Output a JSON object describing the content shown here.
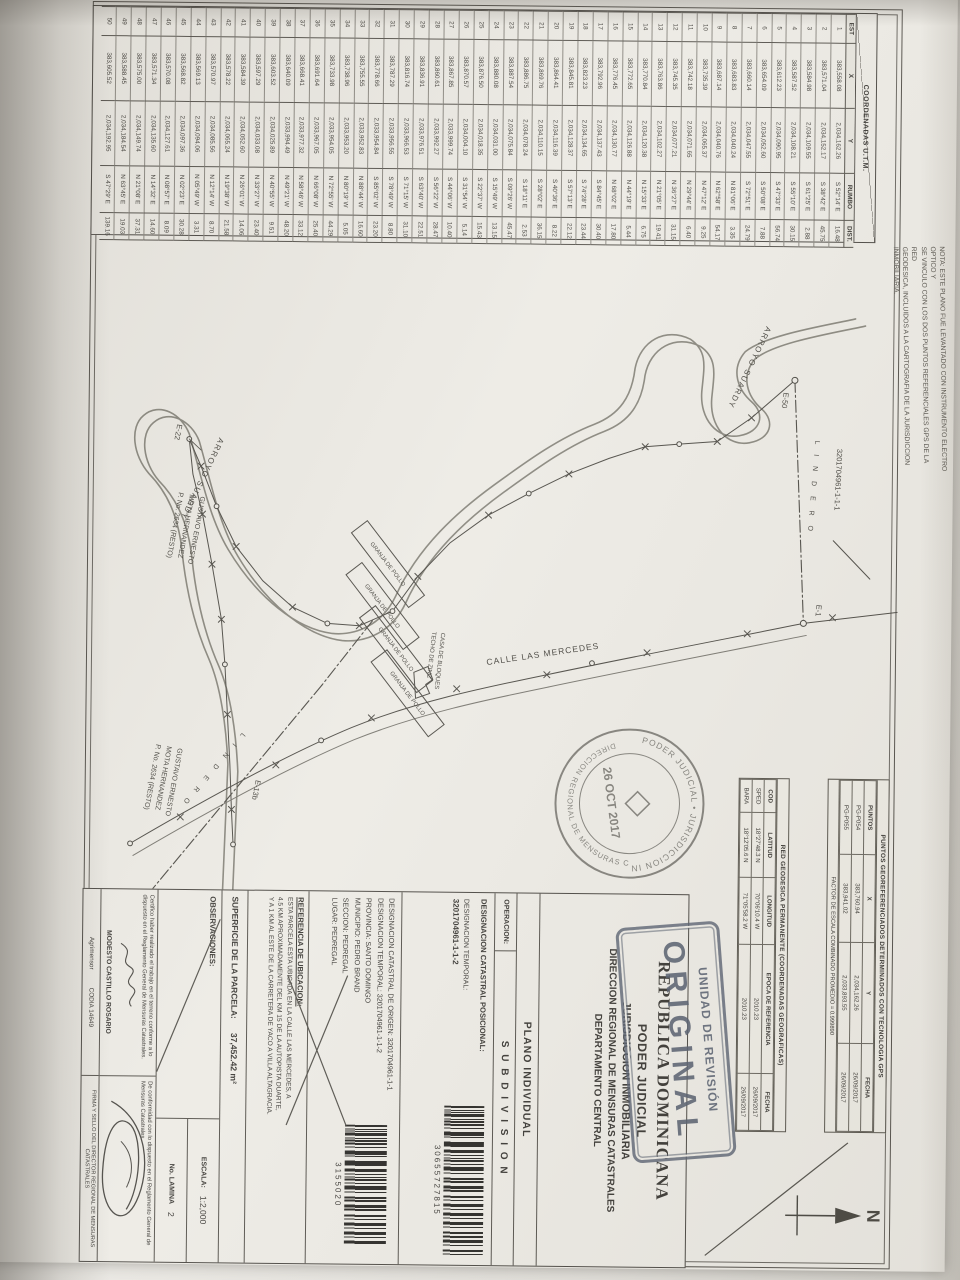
{
  "colors": {
    "ink": "#3c3a36",
    "stamp_ink": "#586070",
    "paper": "#edebe5",
    "stream": "#8a887f"
  },
  "note_margin": {
    "lines": [
      "NOTA: ESTE PLANO FUE LEVANTADO CON INSTRUMENTO ELECTRO OPTICO Y",
      "SE VINCULO CON LOS DOS PUNTOS REFERENCIALES GPS DE LA RED",
      "GEODESICA, INCLUIDOS A LA CARTOGRAFIA DE LA JURISDICCION",
      "INMOBILIARIA."
    ]
  },
  "compass": {
    "label": "N"
  },
  "coord_table": {
    "title": "COORDENADAS U.T.M.",
    "columns": [
      "EST",
      "X",
      "Y",
      "RUMBO",
      "DIST."
    ],
    "rows": [
      [
        "1",
        "383,558.08",
        "2,034,162.26",
        "S 52°14' E",
        "16.48"
      ],
      [
        "2",
        "383,571.04",
        "2,034,152.17",
        "S 38°42' E",
        "45.75"
      ],
      [
        "3",
        "383,584.98",
        "2,034,109.55",
        "S 61°25' E",
        "2.88"
      ],
      [
        "4",
        "383,587.52",
        "2,034,108.21",
        "S 55°10' E",
        "30.15"
      ],
      [
        "5",
        "383,612.23",
        "2,034,090.95",
        "S 47°33' E",
        "56.74"
      ],
      [
        "6",
        "383,654.09",
        "2,034,052.60",
        "S 50°08' E",
        "7.88"
      ],
      [
        "7",
        "383,660.14",
        "2,034,047.55",
        "S 72°51' E",
        "24.79"
      ],
      [
        "8",
        "383,683.83",
        "2,034,040.24",
        "N 81°06' E",
        "3.35"
      ],
      [
        "9",
        "383,687.14",
        "2,034,040.76",
        "N 62°58' E",
        "54.17"
      ],
      [
        "10",
        "383,735.39",
        "2,034,065.37",
        "N 47°12' E",
        "9.25"
      ],
      [
        "11",
        "383,742.18",
        "2,034,071.65",
        "N 29°44' E",
        "6.40"
      ],
      [
        "12",
        "383,745.35",
        "2,034,077.21",
        "N 36°27' E",
        "31.15"
      ],
      [
        "13",
        "383,763.86",
        "2,034,102.27",
        "N 21°05' E",
        "19.41"
      ],
      [
        "14",
        "383,770.84",
        "2,034,120.38",
        "N 15°33' E",
        "6.75"
      ],
      [
        "15",
        "383,772.65",
        "2,034,126.88",
        "N 44°19' E",
        "5.44"
      ],
      [
        "16",
        "383,776.45",
        "2,034,130.77",
        "N 68°02' E",
        "17.80"
      ],
      [
        "17",
        "383,792.96",
        "2,034,137.43",
        "S 84°45' E",
        "30.40"
      ],
      [
        "18",
        "383,823.23",
        "2,034,134.65",
        "S 74°28' E",
        "23.44"
      ],
      [
        "19",
        "383,845.81",
        "2,034,128.37",
        "S 57°13' E",
        "22.12"
      ],
      [
        "20",
        "383,864.41",
        "2,034,116.39",
        "S 40°36' E",
        "8.22"
      ],
      [
        "21",
        "383,869.76",
        "2,034,110.15",
        "S 28°02' E",
        "36.15"
      ],
      [
        "22",
        "383,886.75",
        "2,034,078.24",
        "S 18°11' E",
        "2.53"
      ],
      [
        "23",
        "383,887.54",
        "2,034,075.84",
        "S 09°26' W",
        "45.47"
      ],
      [
        "24",
        "383,880.08",
        "2,034,031.00",
        "S 15°49' W",
        "13.15"
      ],
      [
        "25",
        "383,876.50",
        "2,034,018.35",
        "S 22°37' W",
        "15.43"
      ],
      [
        "26",
        "383,870.57",
        "2,034,004.10",
        "S 31°54' W",
        "5.14"
      ],
      [
        "27",
        "383,867.85",
        "2,033,999.74",
        "S 44°06' W",
        "10.40"
      ],
      [
        "28",
        "383,860.61",
        "2,033,992.27",
        "S 56°22' W",
        "28.47"
      ],
      [
        "29",
        "383,836.91",
        "2,033,976.51",
        "S 63°40' W",
        "22.51"
      ],
      [
        "30",
        "383,816.74",
        "2,033,966.53",
        "S 71°15' W",
        "31.10"
      ],
      [
        "31",
        "383,787.29",
        "2,033,956.55",
        "S 78°49' W",
        "8.80"
      ],
      [
        "32",
        "383,778.66",
        "2,033,954.84",
        "S 85°02' W",
        "23.20"
      ],
      [
        "33",
        "383,755.55",
        "2,033,952.83",
        "N 88°44' W",
        "16.60"
      ],
      [
        "34",
        "383,738.96",
        "2,033,953.20",
        "N 80°19' W",
        "5.05"
      ],
      [
        "35",
        "383,733.98",
        "2,033,954.05",
        "N 72°55' W",
        "44.29"
      ],
      [
        "36",
        "383,691.64",
        "2,033,967.05",
        "N 66°08' W",
        "25.40"
      ],
      [
        "37",
        "383,668.41",
        "2,033,977.32",
        "N 58°46' W",
        "33.12"
      ],
      [
        "38",
        "383,640.09",
        "2,033,994.49",
        "N 49°21' W",
        "48.20"
      ],
      [
        "39",
        "383,603.52",
        "2,034,025.89",
        "N 40°55' W",
        "9.51"
      ],
      [
        "40",
        "383,597.29",
        "2,034,033.08",
        "N 33°27' W",
        "23.40"
      ],
      [
        "41",
        "383,584.39",
        "2,034,052.60",
        "N 26°01' W",
        "14.06"
      ],
      [
        "42",
        "383,578.22",
        "2,034,065.24",
        "N 19°38' W",
        "21.58"
      ],
      [
        "43",
        "383,570.97",
        "2,034,085.56",
        "N 12°14' W",
        "8.70"
      ],
      [
        "44",
        "383,569.13",
        "2,034,094.06",
        "N 05°49' W",
        "3.31"
      ],
      [
        "45",
        "383,568.82",
        "2,034,097.36",
        "N 02°23' E",
        "30.28"
      ],
      [
        "46",
        "383,570.08",
        "2,034,127.61",
        "N 08°57' E",
        "8.09"
      ],
      [
        "47",
        "383,571.34",
        "2,034,135.60",
        "N 14°32' E",
        "14.60"
      ],
      [
        "48",
        "383,575.00",
        "2,034,149.74",
        "N 21°08' E",
        "37.31"
      ],
      [
        "49",
        "383,588.45",
        "2,034,184.54",
        "N 63°45' E",
        "19.03"
      ],
      [
        "50",
        "383,605.52",
        "2,034,192.95",
        "S 47°29' E",
        "139.16"
      ]
    ]
  },
  "geo_table_gps": {
    "title": "PUNTOS GEOREFERENCIADOS DETERMINADOS CON TECNOLOGIA GPS",
    "columns": [
      "PUNTOS",
      "X",
      "Y",
      "FECHA"
    ],
    "rows": [
      [
        "PG-P054",
        "383,760.94",
        "2,034,162.26",
        "26/09/2017"
      ],
      [
        "PG-P055",
        "383,941.02",
        "2,033,893.55",
        "26/09/2017"
      ]
    ],
    "factor_note": "FACTOR DE ESCALA COMBINADO PROMEDIO = 0.999890"
  },
  "geo_table_red": {
    "title": "RED GEODESICA PERMANENTE (COORDENADAS GEOGRAFICAS)",
    "columns": [
      "COD",
      "LATITUD",
      "LONGITUD",
      "EPOCA DE REFERENCIA",
      "FECHA"
    ],
    "rows": [
      [
        "SPED",
        "18°27'48.3 N",
        "70°06'10.4 W",
        "2010.23",
        "26/09/2017"
      ],
      [
        "BARA",
        "18°12'05.6 N",
        "71°05'58.2 W",
        "2010.23",
        "26/09/2017"
      ]
    ]
  },
  "map": {
    "arroyo_label": "ARROYO SUARDY",
    "calle_label": "CALLE LAS MERCEDES",
    "lindero_label": "L I N D E R O",
    "granja_label": "GRANJA DE POLLO",
    "casa_lines": [
      "CASA DE BLOQUES",
      "TECHO DE ZINC"
    ],
    "station_e50": "E-50",
    "station_e1": "E-1",
    "station_e22": "E-22",
    "station_e13b": "E-13b",
    "neighbor_parcel": "3201704961-1-1-1",
    "owner_lines": [
      "GUSTAVO ERNESTO",
      "MOTA HERNANDEZ",
      "P. No. 2634 (RESTO)"
    ]
  },
  "stamps": {
    "review_box": {
      "line1": "UNIDAD DE REVISIÓN",
      "line2": "ORIGINAL"
    },
    "round": {
      "top_arc": "PODER JUDICIAL • JURISDICCION INMOBILIARIA",
      "bottom_arc": "DIRECCION REGIONAL DE MENSURAS CATASTRALES",
      "date": "26 OCT 2017"
    }
  },
  "title_block": {
    "country": "REPUBLICA DOMINICANA",
    "org1": "PODER JUDICIAL",
    "org2": "JURISDICCION INMOBILIARIA",
    "org3": "DIRECCION REGIONAL DE MENSURAS CATASTRALES",
    "org4": "DEPARTAMENTO CENTRAL",
    "plan_type": "PLANO INDIVIDUAL",
    "operacion_label": "OPERACION:",
    "operacion_value": "S U B D I V I S I O N",
    "posicional_label": "DESIGNACION CATASTRAL POSICIONAL:",
    "temporal_label": "DESIGNACION TEMPORAL:",
    "temporal_value": "3201704961-1-1-2",
    "barcode1_number": "30655727815",
    "origen_line": "DESIGNACION CATASTRAL DE ORIGEN: 3201704961-1-1",
    "temporal_line": "DESIGNACION TEMPORAL: 3201704961-1-1-2",
    "provincia": "PROVINCIA: SANTO DOMINGO",
    "municipio": "MUNICIPIO: PEDRO BRAND",
    "seccion": "SECCION: PEDREGAL",
    "lugar": "LUGAR: PEDREGAL",
    "barcode2_number": "3155020",
    "referencia_label": "REFERENCIA DE UBICACION:",
    "referencia_lines": [
      "ESTA PARCELA ESTA UBICADA EN LA CALLE LAS MERCEDES, A",
      "4.5 KM APROXIMADAMENTE DEL KM 15 DE LA AUTOPISTA DUARTE,",
      "Y A 1 KM AL ESTE DE LA CARRETERA DE YACO A VILLA ALTAGRACIA."
    ],
    "superficie_label": "SUPERFICIE DE LA PARCELA:",
    "superficie_value": "37,452.42 m²",
    "observaciones_label": "OBSERVACIONES:",
    "escala_label": "ESCALA:",
    "escala_value": "1:2,000",
    "lamina_label": "No. LAMINA",
    "lamina_value": "2",
    "cert_left": "Certifico haber realizado el trabajo en el terreno conforme a lo dispuesto en el Reglamento General de Mensuras Catastrales.",
    "cert_right": "De conformidad con lo dispuesto en el Reglamento General de Mensuras Catastrales.",
    "surveyor_name": "MODESTO CASTILLO ROSARIO",
    "surveyor_role": "Agrimensor",
    "surveyor_codia": "CODIA 14649",
    "director_strip": "FIRMA Y SELLO DEL DIRECTOR REGIONAL DE MENSURAS CATASTRALES"
  }
}
